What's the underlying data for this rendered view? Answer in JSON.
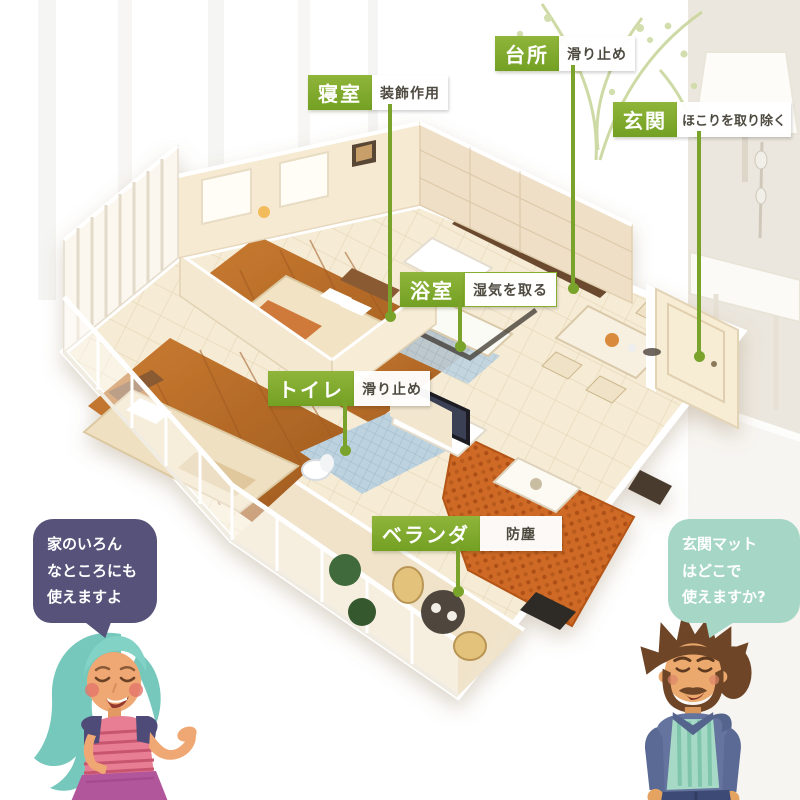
{
  "colors": {
    "accent_green": "#79a32a",
    "bubble_left": "#56527a",
    "bubble_right": "#a6d7c6",
    "wood_floor": "#b8682a",
    "sofa_orange": "#cf6a28"
  },
  "callouts": [
    {
      "id": "bedroom",
      "room": "寝室",
      "note": "装飾作用"
    },
    {
      "id": "kitchen",
      "room": "台所",
      "note": "滑り止め"
    },
    {
      "id": "entrance",
      "room": "玄関",
      "note": "ほこりを取り除く"
    },
    {
      "id": "bathroom",
      "room": "浴室",
      "note": "湿気を取る"
    },
    {
      "id": "toilet",
      "room": "トイレ",
      "note": "滑り止め"
    },
    {
      "id": "veranda",
      "room": "ベランダ",
      "note": "防塵"
    }
  ],
  "speech_left": {
    "lines": [
      "家のいろん",
      "なところにも",
      "使えますよ"
    ]
  },
  "speech_right": {
    "lines": [
      "玄関マット",
      "はどこで",
      "使えますか?"
    ]
  }
}
